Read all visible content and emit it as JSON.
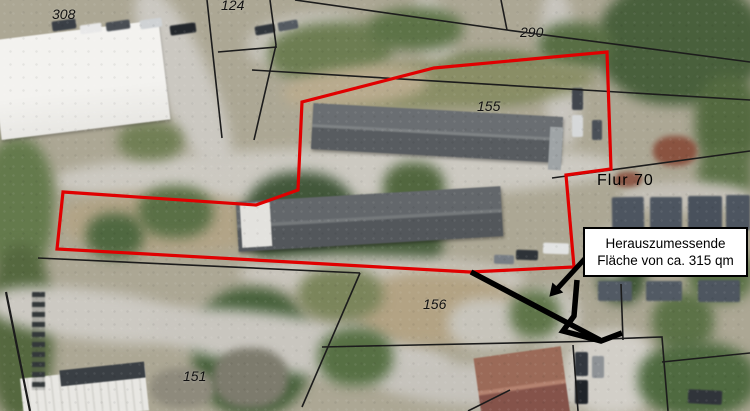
{
  "map": {
    "flur_label": "Flur 70",
    "parcel_labels": [
      {
        "id": "308"
      },
      {
        "id": "124"
      },
      {
        "id": "290"
      },
      {
        "id": "155"
      },
      {
        "id": "156"
      },
      {
        "id": "151"
      }
    ],
    "callout": {
      "line1": "Herauszumessende",
      "line2": "Fläche von ca. 315 qm"
    },
    "colors": {
      "boundary_red": "#e00000",
      "annotation_black": "#000000",
      "cadastral_line": "#1c1c1c"
    }
  }
}
